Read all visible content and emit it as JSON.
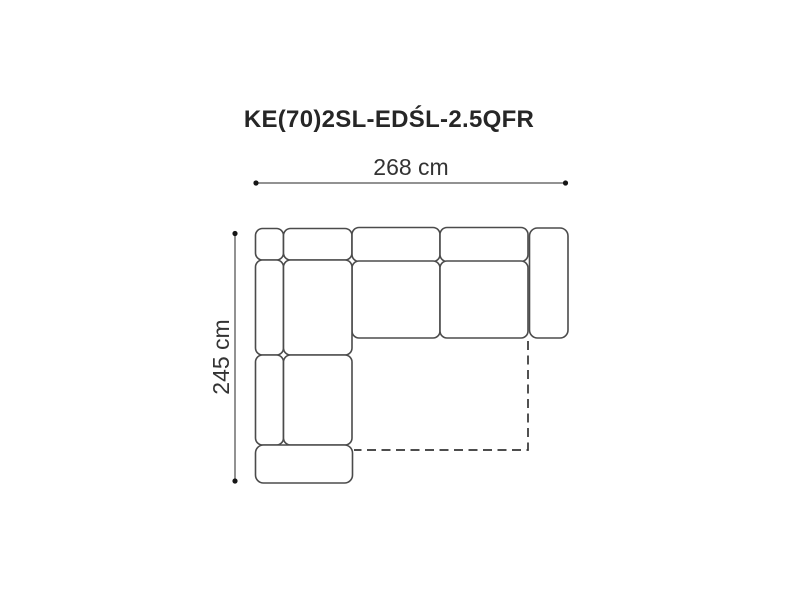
{
  "title": "KE(70)2SL-EDŚL-2.5QFR",
  "dimensions": {
    "width_label": "268 cm",
    "depth_label": "245 cm"
  },
  "diagram": {
    "type": "corner-sofa-top-view-schematic",
    "description": "Top view outline of an L-shaped corner sofa; dashed outline marks fold-out sleeping function area",
    "parts": [
      "corner-back-cushion",
      "corner-backrest",
      "back-cushion-1",
      "back-cushion-2",
      "right-armrest",
      "seat-cushion-1",
      "seat-cushion-2",
      "left-backrest-upper",
      "corner-seat",
      "left-backrest-lower",
      "chaise-seat",
      "bottom-armrest",
      "sleeping-function-dashed-outline"
    ],
    "colors": {
      "background": "#ffffff",
      "sofa_outline": "#4b4b4b",
      "dimension_line": "#6f6f6f",
      "dimension_dot": "#161616",
      "dashed_outline": "#343434",
      "title_text": "#262626",
      "label_text": "#333333"
    }
  }
}
